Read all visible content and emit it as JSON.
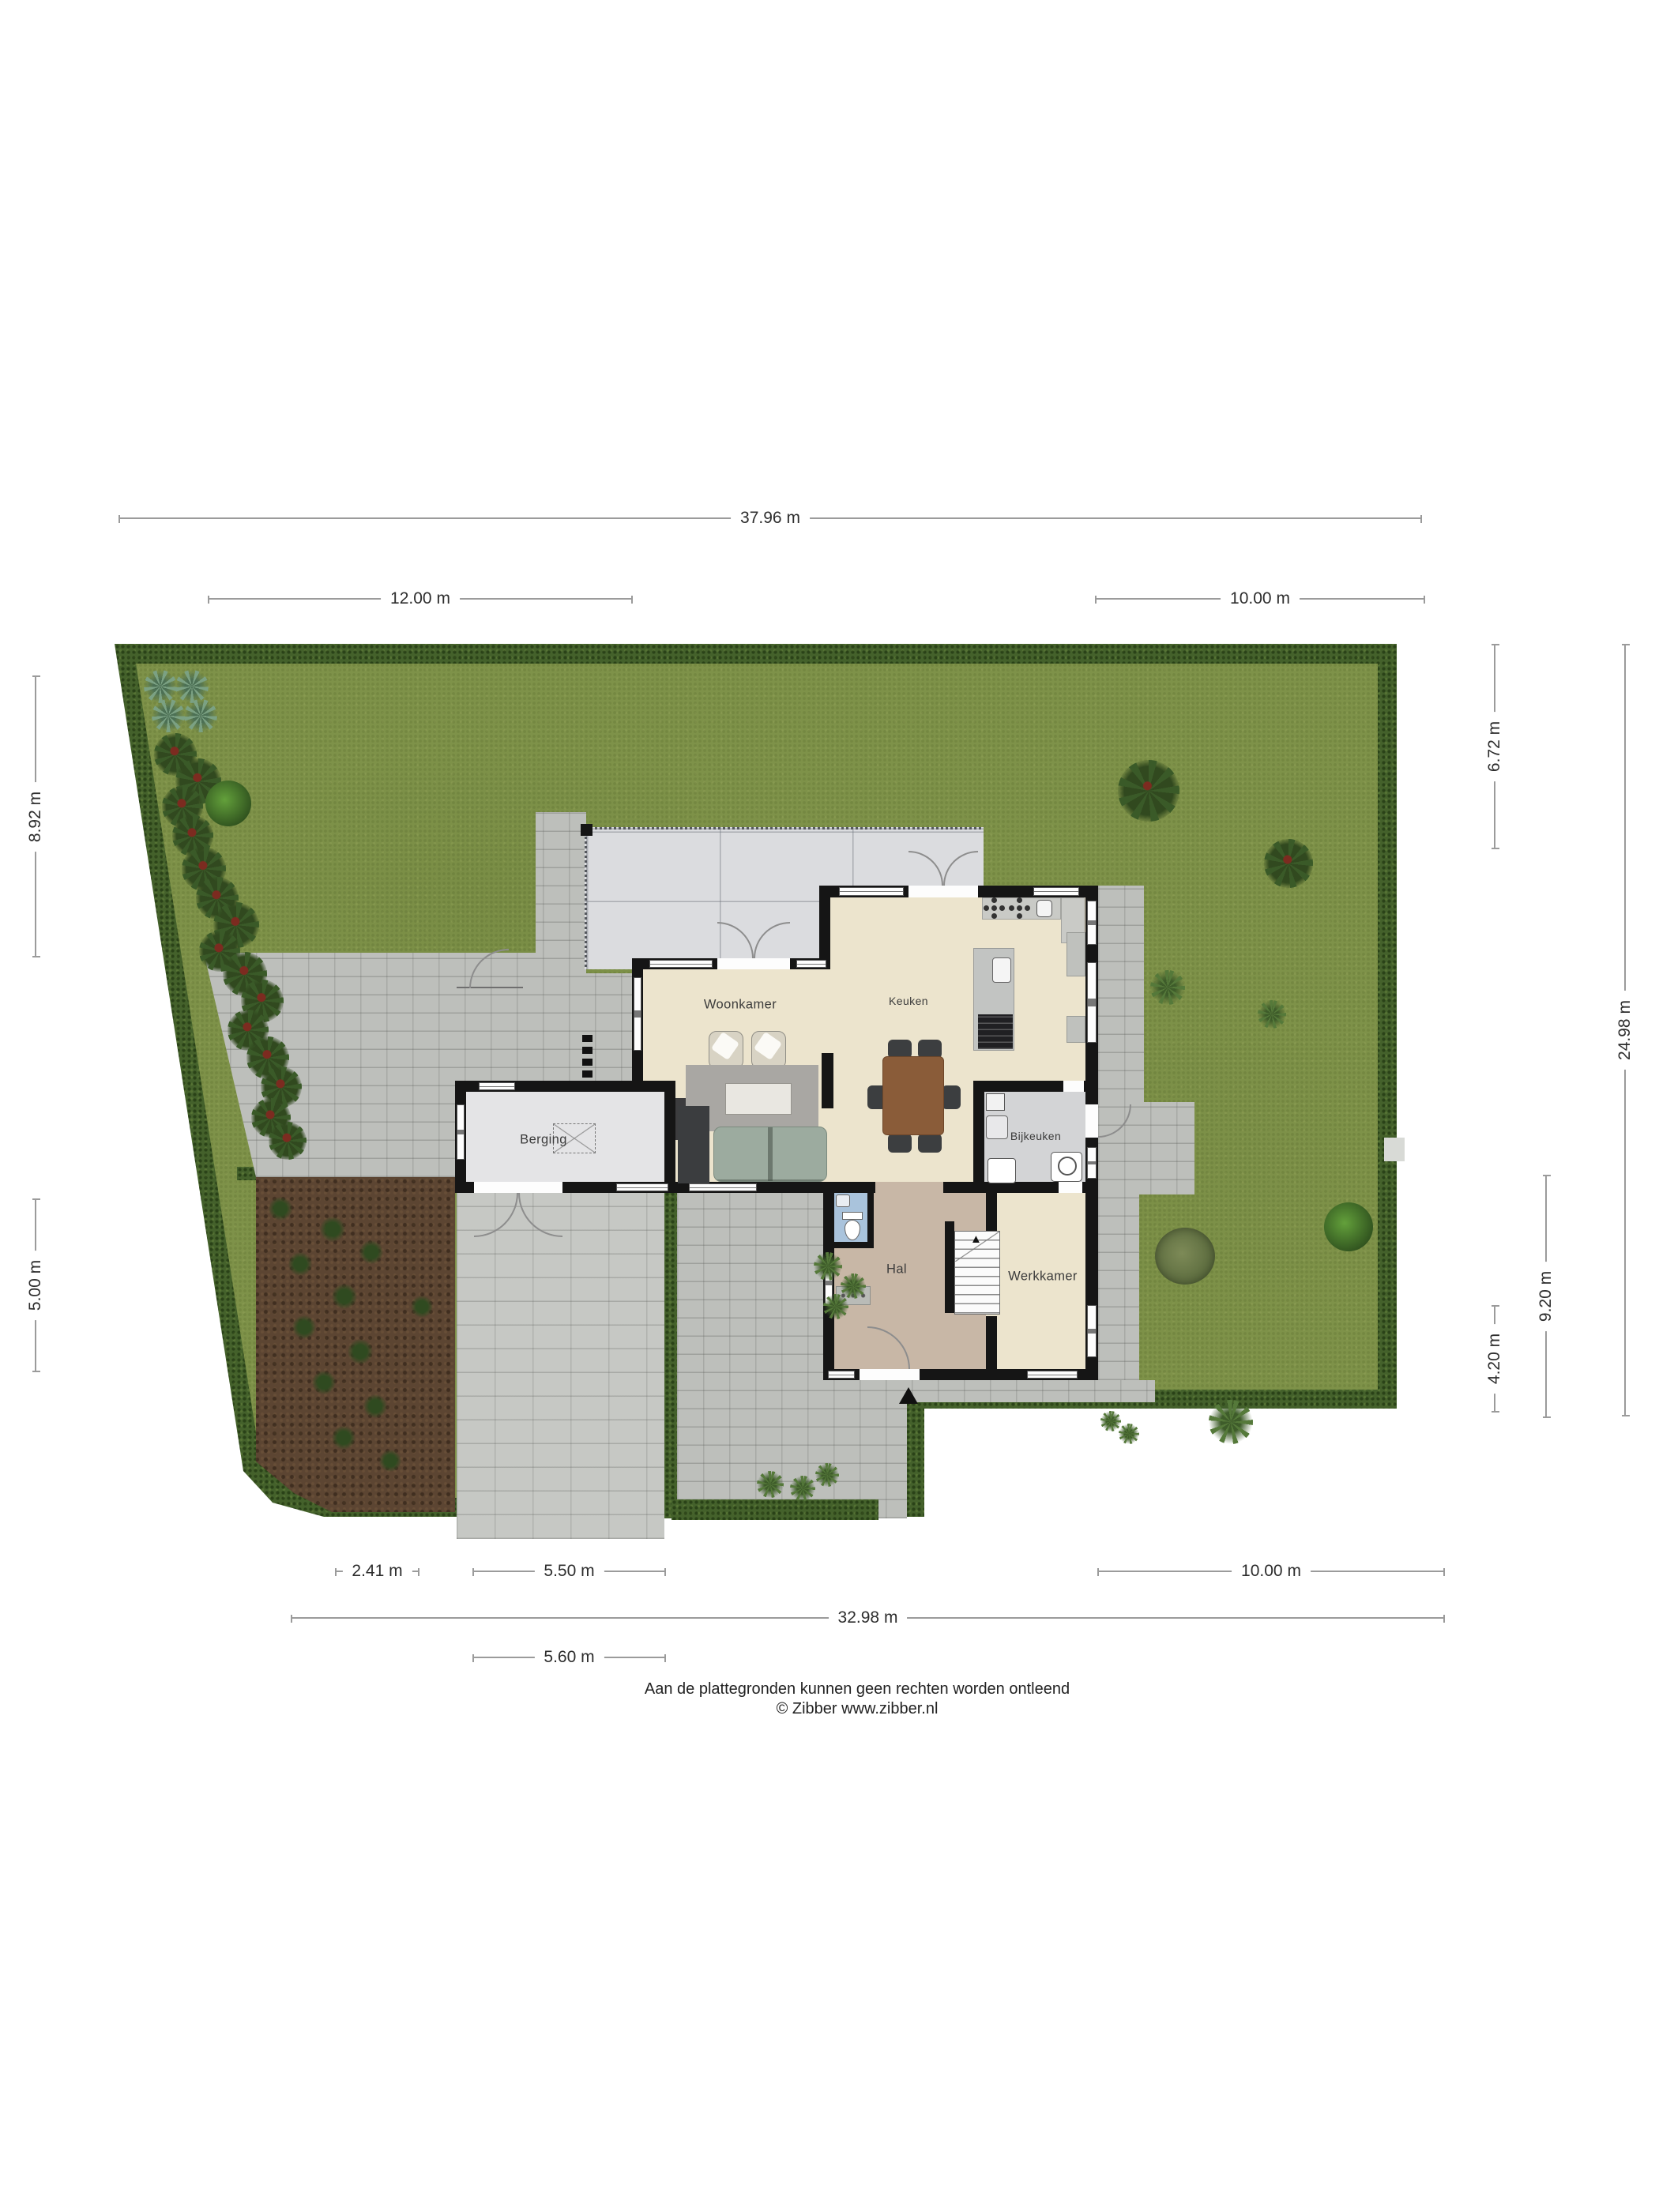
{
  "rooms": {
    "woonkamer": "Woonkamer",
    "keuken": "Keuken",
    "berging": "Berging",
    "bijkeuken": "Bijkeuken",
    "hal": "Hal",
    "werkkamer": "Werkkamer"
  },
  "dimensions": {
    "top_total": "37.96 m",
    "top_left": "12.00 m",
    "top_right": "10.00 m",
    "left_upper": "8.92 m",
    "left_lower": "5.00 m",
    "right_inner_upper": "6.72 m",
    "right_outer": "24.98 m",
    "right_inner_lower": "9.20 m",
    "right_inner_bottom": "4.20 m",
    "bottom_left": "2.41 m",
    "bottom_mid": "5.50 m",
    "bottom_right": "10.00 m",
    "bottom_total": "32.98 m",
    "bottom_drive": "5.60 m"
  },
  "icons": {
    "entrance_arrow": "▲",
    "stairs_arrow": "▲"
  },
  "footer": {
    "disclaimer": "Aan de plattegronden kunnen geen rechten worden ontleend",
    "credit": "© Zibber www.zibber.nl"
  },
  "colors": {
    "grass": "#7e9249",
    "hedge": "#44612b",
    "paving": "#bdbfbb",
    "driveway": "#c6c8c4",
    "terrace": "#dbdcdf",
    "floor_main": "#ece4cd",
    "floor_hal": "#c8b7a6",
    "floor_utility": "#d3d4d6",
    "floor_storage": "#e4e4e6",
    "floor_toilet": "#a9c3dc",
    "wall": "#151515",
    "soil": "#5c4532",
    "dimension_line": "#9b9b9b"
  }
}
